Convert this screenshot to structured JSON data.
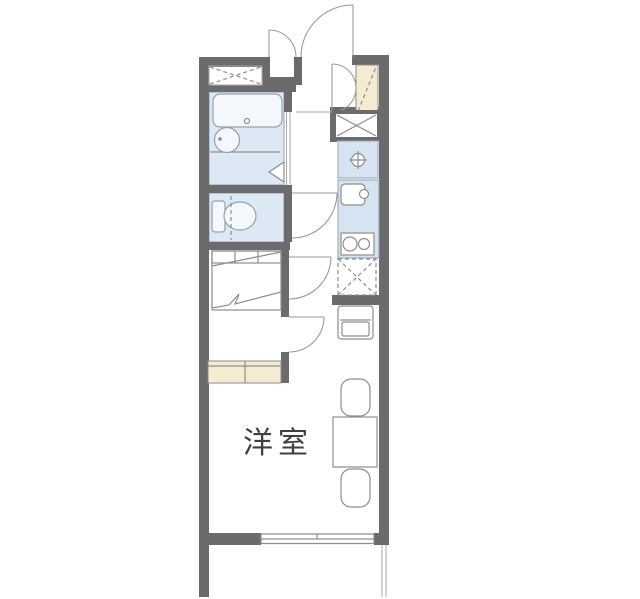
{
  "plan": {
    "type": "apartment-floor-plan",
    "rooms": {
      "main": {
        "label": "洋室"
      }
    },
    "fixtures": [
      "entry-door",
      "meter-box-door",
      "shoe-cabinet",
      "closet-double-door",
      "storage-shelf-x",
      "washing-machine-space",
      "kitchen-sink",
      "gas-stove",
      "refrigerator-space",
      "bathtub",
      "wash-basin",
      "bath-folding-door",
      "toilet",
      "bed",
      "counter-storage",
      "tv-stand",
      "dining-table",
      "dining-chair",
      "interior-door",
      "window",
      "balcony-rail"
    ]
  },
  "colors": {
    "bg": "#ffffff",
    "wall": "#6b6b6b",
    "water": "#dce8f4",
    "kitchen-water": "#d6e3f2",
    "fixture": "#f4f8fd",
    "wood": "#f6ebd2",
    "line": "#8e8e8e",
    "line-blue": "#92a1b2",
    "text": "#3f3f3f"
  }
}
